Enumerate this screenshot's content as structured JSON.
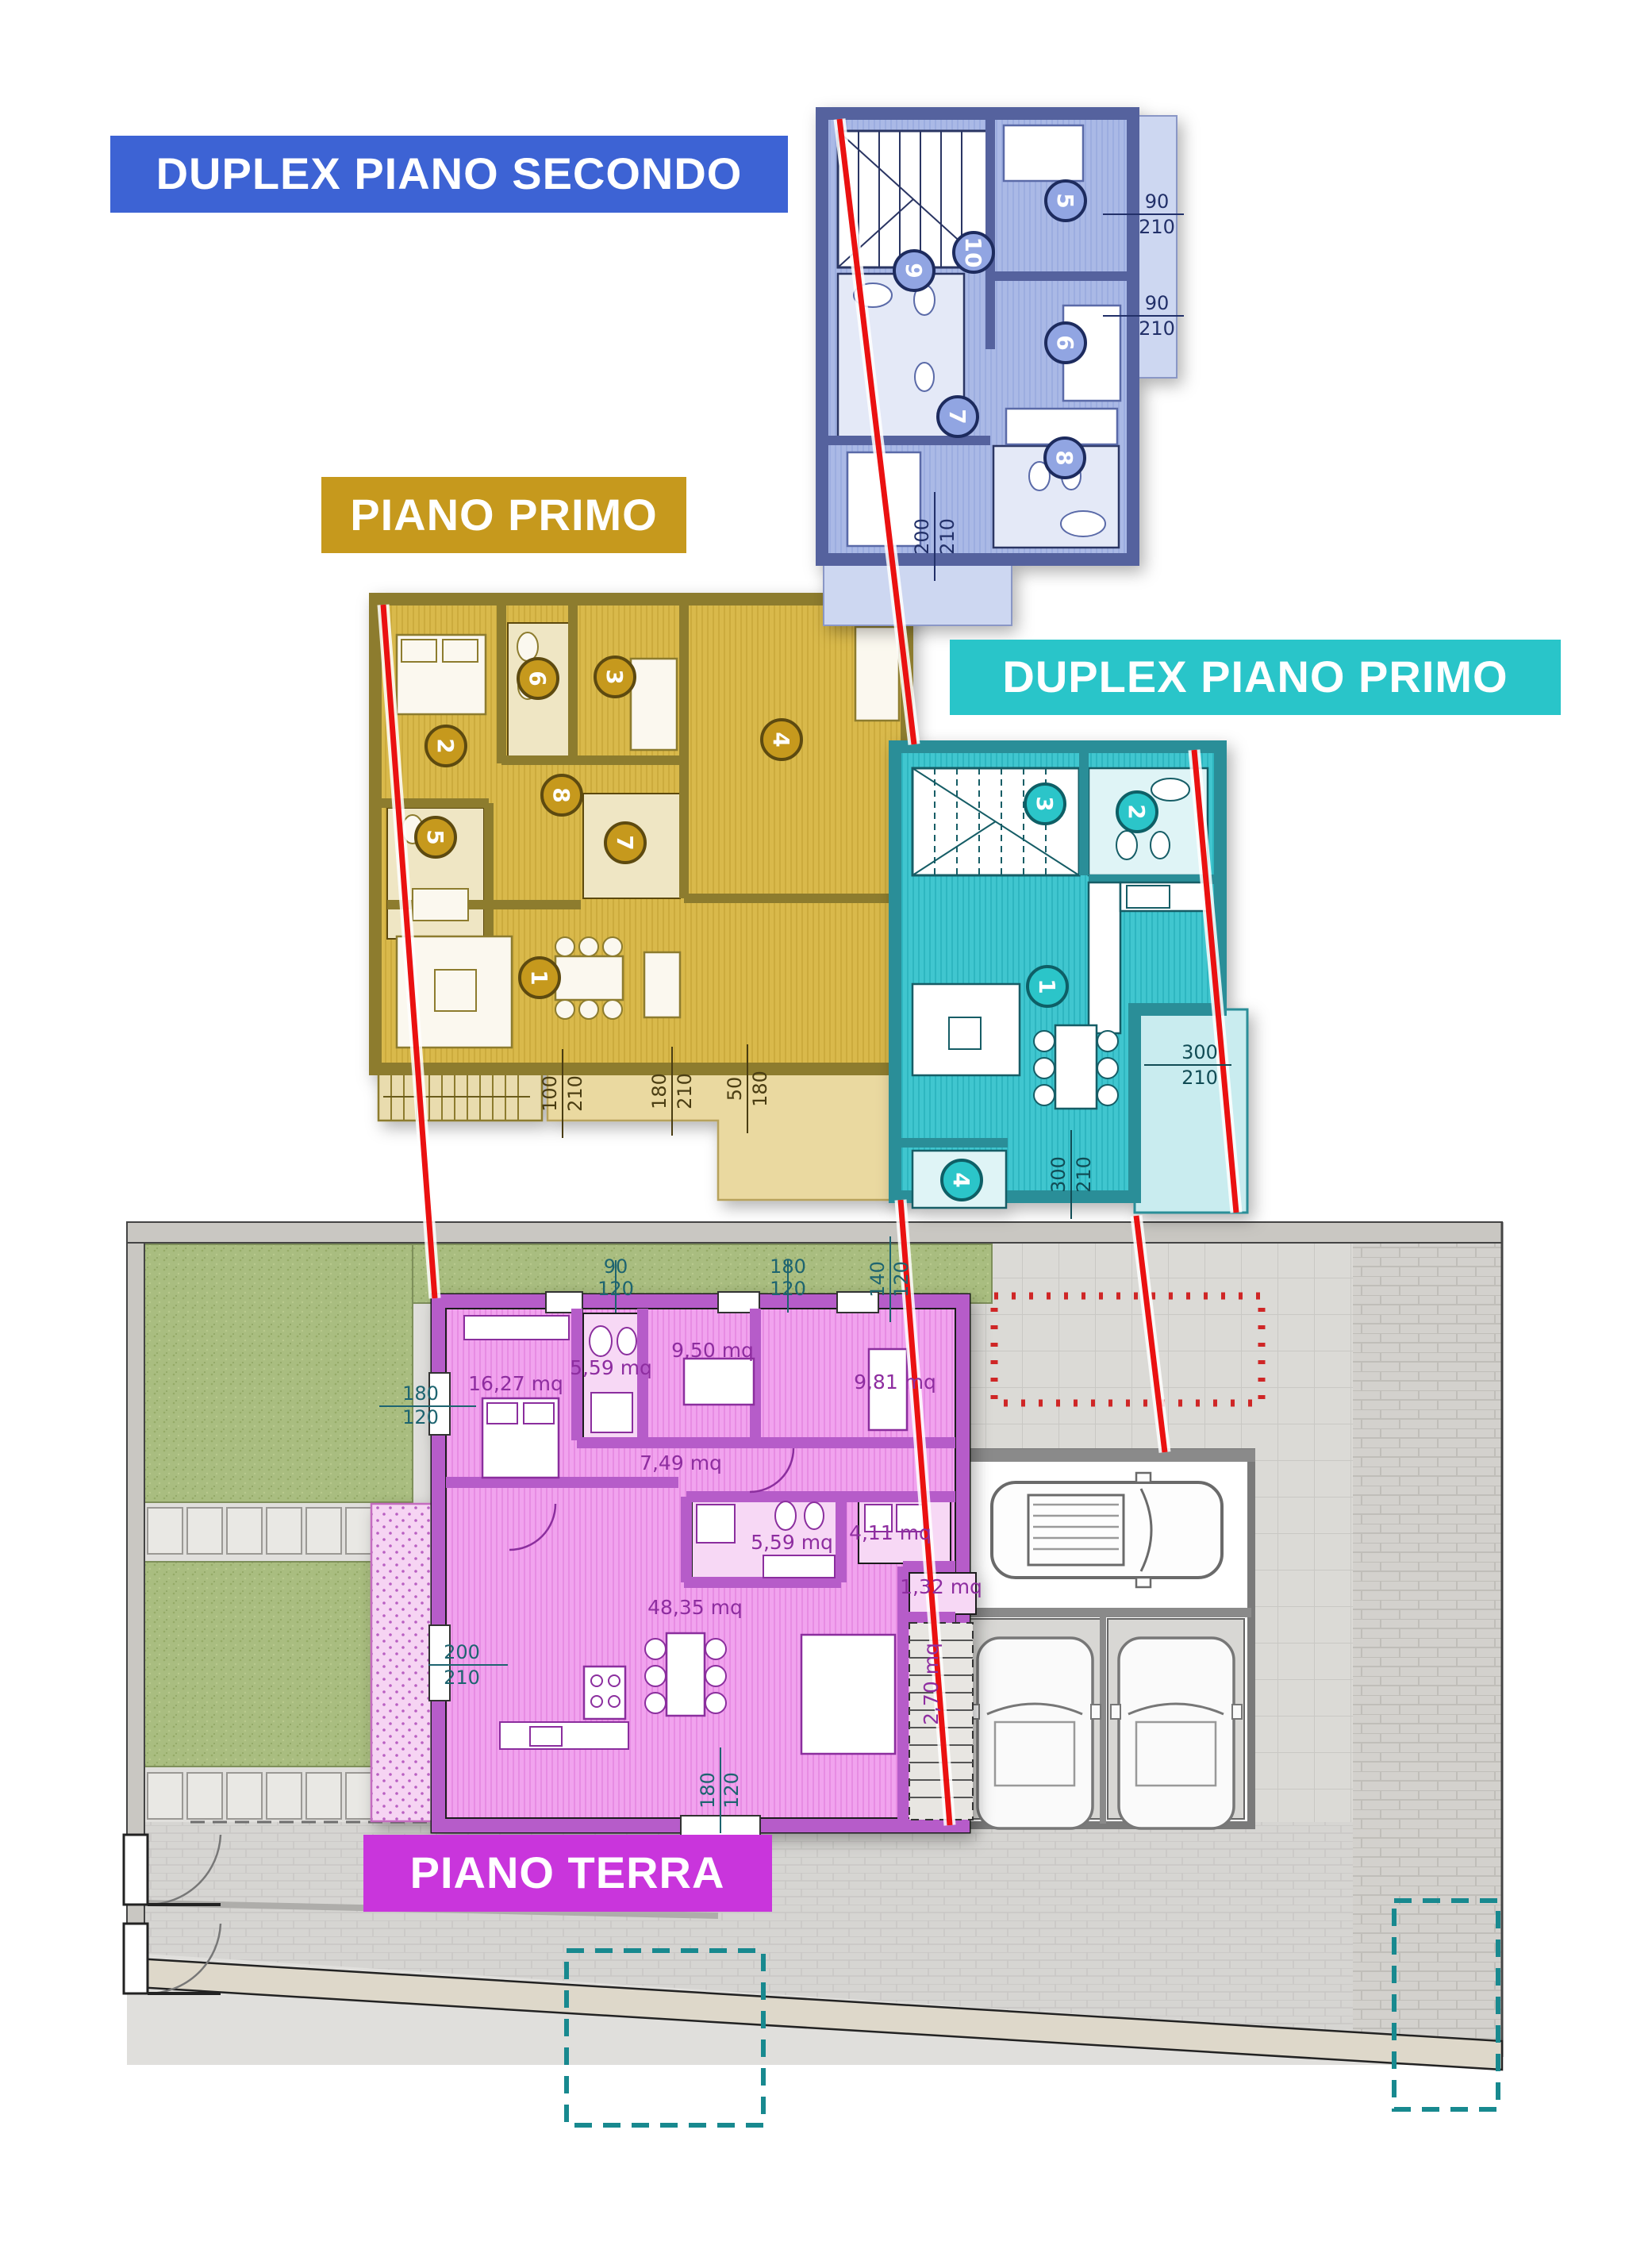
{
  "banners": {
    "secondo": {
      "label": "DUPLEX PIANO SECONDO",
      "color": "#3d63d4"
    },
    "primo": {
      "label": "PIANO PRIMO",
      "color": "#c6991d"
    },
    "duplex_primo": {
      "label": "DUPLEX PIANO PRIMO",
      "color": "#29c5c9"
    },
    "terra": {
      "label": "PIANO TERRA",
      "color": "#c935dc"
    }
  },
  "plans": {
    "secondo": {
      "rooms": [
        "5",
        "6",
        "7",
        "8",
        "9",
        "10"
      ],
      "dims": [
        {
          "a": "90",
          "b": "210"
        },
        {
          "a": "90",
          "b": "210"
        },
        {
          "a": "200",
          "b": "210"
        }
      ]
    },
    "primo": {
      "rooms": [
        "1",
        "2",
        "3",
        "4",
        "5",
        "6",
        "7",
        "8"
      ],
      "dims": [
        {
          "a": "100",
          "b": "210"
        },
        {
          "a": "180",
          "b": "210"
        },
        {
          "a": "50",
          "b": "180"
        }
      ]
    },
    "duplex_primo": {
      "rooms": [
        "1",
        "2",
        "3",
        "4"
      ],
      "dims": [
        {
          "a": "300",
          "b": "210"
        },
        {
          "a": "300",
          "b": "210"
        }
      ]
    },
    "terra": {
      "areas": [
        "16,27 mq",
        "5,59 mq",
        "9,50 mq",
        "9,81 mq",
        "7,49 mq",
        "5,59 mq",
        "4,11 mq",
        "1,32 mq",
        "48,35 mq",
        "2,70 mq"
      ],
      "dims": [
        {
          "a": "90",
          "b": "120"
        },
        {
          "a": "180",
          "b": "120"
        },
        {
          "a": "140",
          "b": "120"
        },
        {
          "a": "180",
          "b": "120"
        },
        {
          "a": "200",
          "b": "210"
        },
        {
          "a": "180",
          "b": "120"
        }
      ]
    }
  },
  "colors": {
    "blue_wall": "#55629e",
    "blue_floor": "#aab9e6",
    "gold_wall": "#8d7b2e",
    "gold_floor": "#d9b94b",
    "teal_wall": "#2a8e98",
    "teal_floor": "#3fc6cf",
    "magenta_wall": "#b65cc9",
    "magenta_floor": "#f1a3ee",
    "grass": "#a9bd80",
    "red_line": "#ea1111",
    "red_dashed": "#cf2626",
    "teal_dashed": "#18898f"
  }
}
